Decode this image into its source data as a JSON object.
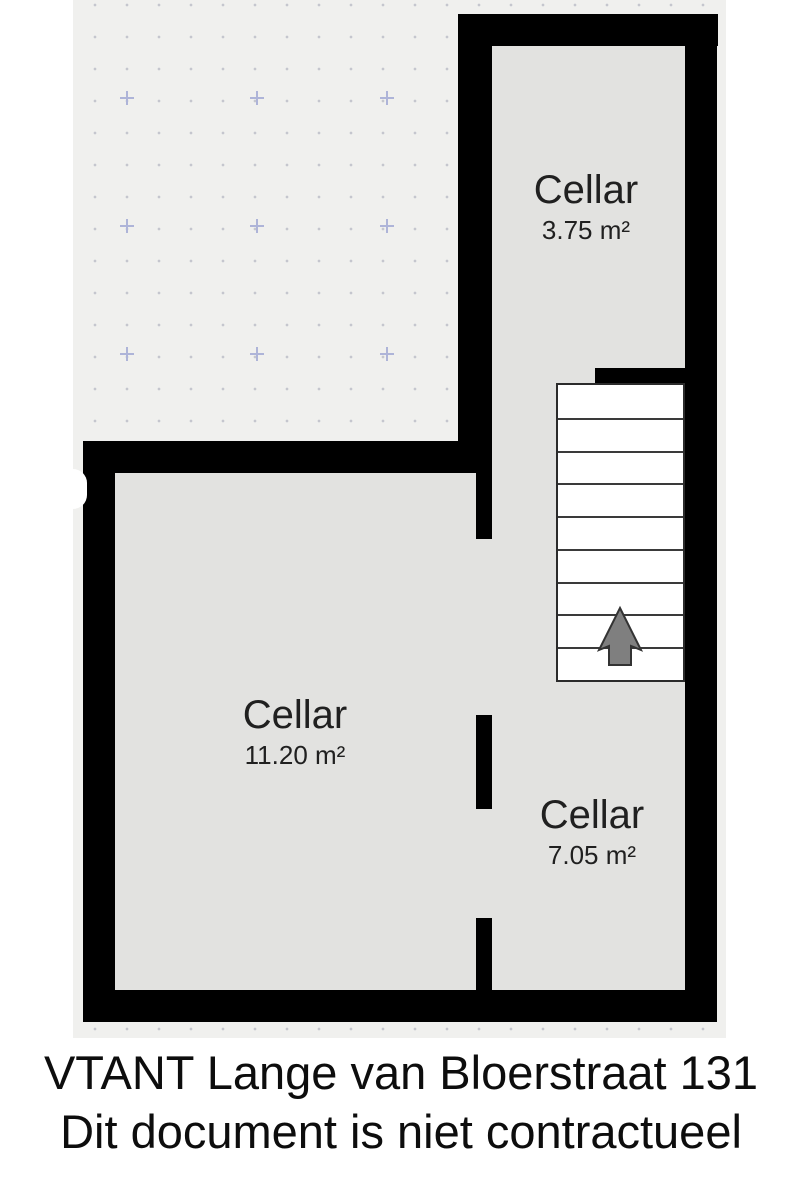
{
  "plan": {
    "rooms": [
      {
        "name": "Cellar",
        "area": "3.75 m²"
      },
      {
        "name": "Cellar",
        "area": "11.20 m²"
      },
      {
        "name": "Cellar",
        "area": "7.05 m²"
      }
    ],
    "stairs": {
      "step_count": 9,
      "direction": "up"
    },
    "grid": {
      "cross_positions": [
        [
          54,
          98
        ],
        [
          184,
          98
        ],
        [
          314,
          98
        ],
        [
          54,
          226
        ],
        [
          184,
          226
        ],
        [
          314,
          226
        ],
        [
          54,
          354
        ],
        [
          184,
          354
        ],
        [
          314,
          354
        ]
      ]
    }
  },
  "footer": {
    "line1": "VTANT Lange van Bloerstraat 131",
    "line2": "Dit document is niet contractueel"
  },
  "colors": {
    "wall": "#000000",
    "room_fill": "#e2e2e0",
    "canvas_background": "#f0f0ee",
    "grid_dot": "#c5c6ce",
    "grid_cross": "#aeb4d8",
    "stair_fill": "#ffffff",
    "stair_border": "#2b2b2b",
    "arrow_fill": "#7f7f7f",
    "arrow_stroke": "#333333",
    "label_text": "#202020",
    "footer_text": "#0d0d0d"
  }
}
